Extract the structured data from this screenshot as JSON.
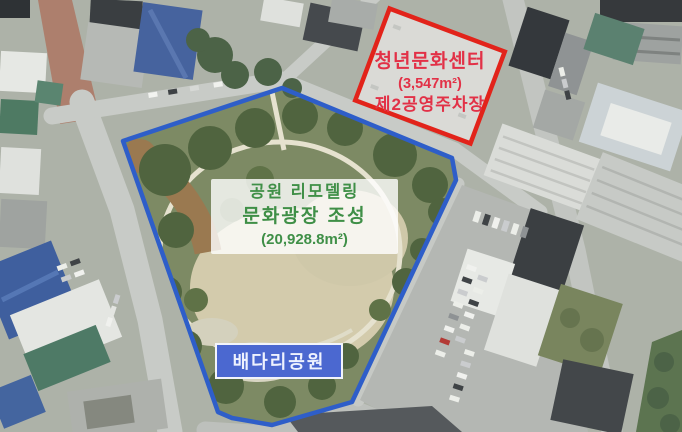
{
  "figure": {
    "type": "aerial-map-annotation",
    "labels": {
      "youth_center": {
        "title": "청년문화센터",
        "area": "(3,547m²)",
        "subtitle": "제2공영주차장"
      },
      "plaza": {
        "line1": "공원 리모델링",
        "line2": "문화광장 조성",
        "area": "(20,928.8m²)"
      },
      "park_name": {
        "label": "배다리공원"
      }
    },
    "colors": {
      "site_outline": "#e2231a",
      "site_text": "#e23147",
      "plaza_text": "#3f8f47",
      "park_boundary": "#2e5ec9",
      "park_name_bg": "#4b68d0",
      "park_name_text": "#eef2fe"
    }
  }
}
